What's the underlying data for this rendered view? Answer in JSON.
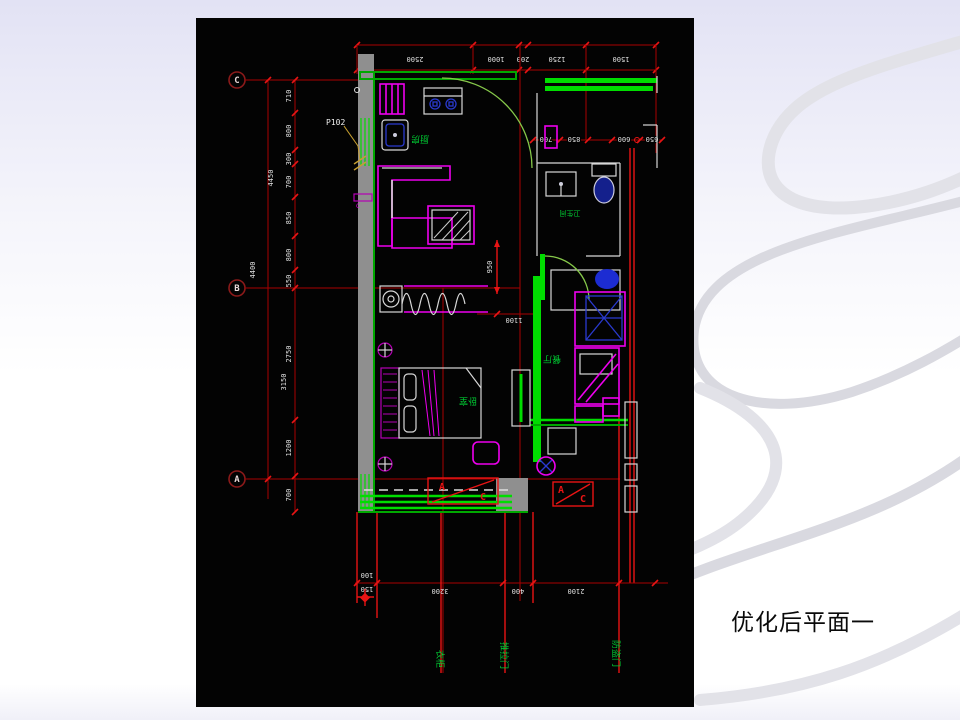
{
  "slide": {
    "caption": "优化后平面一"
  },
  "colors": {
    "bg_top": "#e2e2f4",
    "swirl": "#e2e2e8",
    "swirl2": "#d9d9e0",
    "canvas": "#030303",
    "caption": "#0a0a0a",
    "dim_red": "#a80000",
    "bright_red": "#e81414",
    "wall_green": "#00a800",
    "bright_green": "#00dd00",
    "lt_green": "#86c84a",
    "label_green": "#00cc33",
    "magenta": "#b400b4",
    "bright_magenta": "#ee00ee",
    "blue": "#2a3ad0",
    "white_line": "#d8d8d8",
    "gray_wall": "#8f8f8f",
    "dim_text": "#e2e2e2"
  },
  "grid": [
    "C",
    "B",
    "A"
  ],
  "dims": {
    "top": [
      "2500",
      "1000",
      "200",
      "1250",
      "1500"
    ],
    "left_chain": [
      "710",
      "800",
      "300",
      "700",
      "850",
      "800",
      "550"
    ],
    "left_lower": [
      "2750",
      "1200",
      "700"
    ],
    "overall_upper": "4450",
    "overall_b": "4400",
    "overall_lower": "3150",
    "bottom_small_a": "100",
    "bottom_small_b": "150",
    "bottom": [
      "3200",
      "400",
      "2100"
    ],
    "right_row": [
      "700",
      "850",
      "600",
      "650"
    ],
    "dim_950": "950",
    "dim_1100": "1100"
  },
  "annotations": {
    "p102": "P102",
    "ac_a": "A",
    "ac_c": "C"
  },
  "room_labels": {
    "kitchen": "厨房",
    "bath": "卫生间",
    "dining": "餐厅",
    "bedroom": "卧室"
  },
  "bottom_labels": [
    "衣柜",
    "推拉门",
    "防盗门"
  ]
}
